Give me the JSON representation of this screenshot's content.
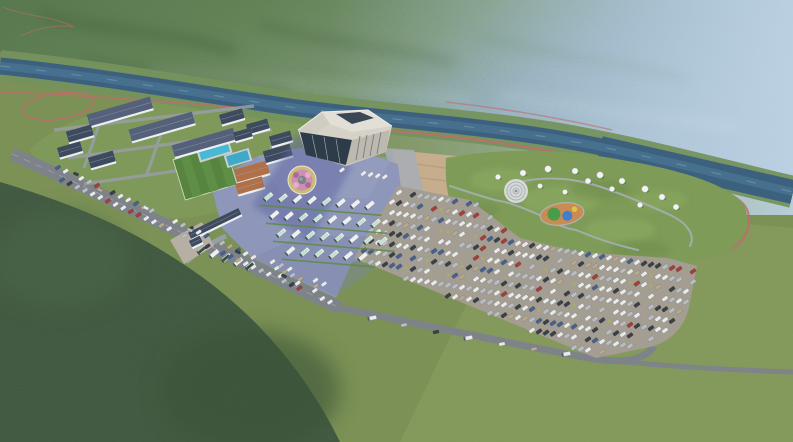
{
  "meta": {
    "type": "aerial-architectural-rendering",
    "description": "Bird's-eye 3D rendering of a riverside tourist service area: visitor center hall, plaza with flower bed, bus lot, large car parking lot, glamping park with dome tents and teepees, dormitory buildings, sports field and pools, set in a forested mountain valley with a river, red trails and drifting clouds",
    "width": 793,
    "height": 442
  },
  "palette": {
    "mountainDark": "#46633e",
    "mountainMid": "#5e7f54",
    "mountainLight": "#7d9a78",
    "hazeBlue": "#a9c2da",
    "valleyGreen": "#7c9155",
    "meadow": "#8a9e5f",
    "forestDark": "#3f5840",
    "forestMid": "#4b6848",
    "river": "#3c617f",
    "riverLight": "#4a7492",
    "bank": "#75925e",
    "trailRed": "#c06c6c",
    "roadGray": "#7e838a",
    "roadLight": "#989ea5",
    "plaza": "#8e97b9",
    "plazaShadow": "#5f65a2",
    "lotGray": "#a49d91",
    "dirt": "#c6ad8e",
    "lawn": "#7f9c5b",
    "field": "#57853f",
    "pool": "#49b8d4",
    "pool2": "#3fa9c9",
    "roofDark": "#3e4a5e",
    "roofSlate": "#55617a",
    "roofOrange": "#b07048",
    "wallWhite": "#eceff2",
    "hallWall": "#d6d2c8",
    "hallRoof": "#e2dfd7",
    "hallGlass": "#2e3c49",
    "busWhite": "#eef1f2",
    "busMint": "#bfe3cf",
    "busDarkGreen": "#37523f",
    "carWhite": "#e8eaec",
    "carSilver": "#b9bec6",
    "carDark": "#3a4048",
    "carRed": "#a23f3b",
    "carBlue": "#46618e",
    "carTan": "#b7a98e",
    "bush": "#a9b35b",
    "treeDark": "#2e4a30",
    "treeMid": "#3d5c38",
    "treeLight": "#4f6f42",
    "cherry": "#d7a6c6",
    "cherry2": "#c791b5",
    "tentWhite": "#f2f3f4",
    "pgBase": "#cd8b52",
    "pgGreen": "#4a9b4a",
    "pgBlue": "#3f7fd0",
    "pgYellow": "#e0c245",
    "flowerPink": "#cf8fb4",
    "flowerRing": "#c9bd72",
    "rock": "#7b828c",
    "cloud": "#ffffff"
  },
  "campus": {
    "buildings": [
      [
        120,
        112,
        66,
        12,
        -16,
        "roofSlate"
      ],
      [
        162,
        127,
        66,
        12,
        -16,
        "roofSlate"
      ],
      [
        204,
        143,
        64,
        12,
        -16,
        "roofSlate"
      ],
      [
        80,
        134,
        26,
        11,
        -16,
        "roofDark"
      ],
      [
        70,
        150,
        24,
        10,
        -16,
        "roofDark"
      ],
      [
        102,
        160,
        26,
        11,
        -16,
        "roofDark"
      ],
      [
        232,
        117,
        24,
        10,
        -16,
        "roofDark"
      ],
      [
        258,
        127,
        22,
        10,
        -16,
        "roofDark"
      ],
      [
        243,
        135,
        18,
        9,
        -16,
        "roofDark"
      ],
      [
        281,
        139,
        22,
        10,
        -16,
        "roofDark"
      ],
      [
        252,
        172,
        34,
        13,
        -16,
        "roofOrange"
      ],
      [
        250,
        186,
        28,
        11,
        -16,
        "roofOrange"
      ],
      [
        278,
        154,
        28,
        12,
        -16,
        "roofDark"
      ],
      [
        215,
        224,
        56,
        7,
        -26,
        "roofDark"
      ],
      [
        196,
        242,
        12,
        7,
        -26,
        "roofDark"
      ]
    ]
  },
  "parking": {
    "bounds": [
      [
        398,
        186
      ],
      [
        470,
        200
      ],
      [
        520,
        238
      ],
      [
        578,
        252
      ],
      [
        668,
        258
      ],
      [
        697,
        266
      ],
      [
        690,
        302
      ],
      [
        652,
        346
      ],
      [
        596,
        358
      ],
      [
        354,
        258
      ],
      [
        376,
        220
      ],
      [
        392,
        196
      ]
    ],
    "row_pitch": 10.6,
    "car_spacing": 7.0,
    "row_slope": 0.16,
    "car_rot": -36,
    "car_colors": [
      [
        "carWhite",
        38
      ],
      [
        "carSilver",
        22
      ],
      [
        "carDark",
        18
      ],
      [
        "carRed",
        6
      ],
      [
        "carBlue",
        8
      ],
      [
        "carTan",
        8
      ]
    ]
  },
  "bus_area": {
    "rows": [
      {
        "x": 268,
        "y": 197,
        "n": 8,
        "step": 14.5,
        "drift": 1.2
      },
      {
        "x": 274,
        "y": 215,
        "n": 8,
        "step": 14.5,
        "drift": 1.2
      },
      {
        "x": 281,
        "y": 233,
        "n": 8,
        "step": 14.5,
        "drift": 1.2
      },
      {
        "x": 290,
        "y": 251,
        "n": 6,
        "step": 14.5,
        "drift": 1.2
      }
    ],
    "entrance_buses": [
      [
        202,
        250
      ],
      [
        214,
        254
      ],
      [
        226,
        258
      ],
      [
        238,
        262
      ],
      [
        250,
        266
      ]
    ]
  },
  "roadside": {
    "strips": [
      {
        "x1": 50,
        "y1": 164,
        "x2": 316,
        "y2": 286,
        "step": 8.4,
        "rot": -34,
        "skip": 0.22
      },
      {
        "x1": 62,
        "y1": 180,
        "x2": 330,
        "y2": 302,
        "step": 8.4,
        "rot": -34,
        "skip": 0.25
      },
      {
        "x1": 264,
        "y1": 258,
        "x2": 324,
        "y2": 284,
        "step": 8.2,
        "rot": -36,
        "skip": 0.3,
        "white": 1
      },
      {
        "x1": 272,
        "y1": 272,
        "x2": 332,
        "y2": 298,
        "step": 8.2,
        "rot": -36,
        "skip": 0.3,
        "white": 1
      },
      {
        "x1": 342,
        "y1": 170,
        "x2": 392,
        "y2": 178,
        "step": 7.2,
        "rot": -38,
        "skip": 0.25,
        "white": 1
      }
    ],
    "road_cars": [
      [
        100,
        190,
        24
      ],
      [
        146,
        208,
        24
      ],
      [
        190,
        230,
        24
      ],
      [
        238,
        252,
        24
      ],
      [
        284,
        276,
        24
      ],
      [
        76,
        174,
        24
      ]
    ],
    "bottom_vehicles": [
      [
        372,
        318,
        -11,
        1
      ],
      [
        404,
        325,
        -11,
        0
      ],
      [
        436,
        332,
        -11,
        0
      ],
      [
        468,
        338,
        -11,
        1
      ],
      [
        502,
        344,
        -11,
        0
      ],
      [
        534,
        349,
        -11,
        0
      ],
      [
        566,
        354,
        -11,
        1
      ]
    ]
  },
  "glamping": {
    "domes": [
      [
        498,
        177,
        2.6
      ],
      [
        523,
        173,
        3
      ],
      [
        548,
        169,
        3.2
      ],
      [
        575,
        171,
        3
      ],
      [
        600,
        175,
        3.2
      ],
      [
        622,
        181,
        3
      ],
      [
        645,
        189,
        3.2
      ],
      [
        662,
        197,
        3
      ],
      [
        676,
        207,
        2.8
      ],
      [
        640,
        205,
        2.6
      ],
      [
        612,
        189,
        2.6
      ],
      [
        588,
        181,
        2.8
      ],
      [
        540,
        186,
        2.4
      ],
      [
        565,
        192,
        2.4
      ]
    ],
    "teepees": [
      [
        628,
        222
      ],
      [
        643,
        229
      ],
      [
        657,
        236
      ],
      [
        671,
        243
      ],
      [
        684,
        247
      ],
      [
        636,
        244
      ],
      [
        650,
        251
      ],
      [
        664,
        256
      ],
      [
        678,
        258
      ],
      [
        694,
        250
      ],
      [
        699,
        237
      ],
      [
        691,
        226
      ]
    ],
    "cabins": [
      [
        505,
        206
      ],
      [
        517,
        210
      ],
      [
        638,
        198
      ],
      [
        652,
        202
      ],
      [
        664,
        206
      ]
    ]
  },
  "vegetation": {
    "lines": [
      {
        "x1": 30,
        "y1": 156,
        "x2": 332,
        "y2": 295,
        "step": 11,
        "r0": 2,
        "r1": 3.2,
        "j": 2.5,
        "skip": 0.12
      },
      {
        "x1": 22,
        "y1": 170,
        "x2": 322,
        "y2": 308,
        "step": 12,
        "r0": 2,
        "r1": 3,
        "j": 2.5,
        "skip": 0.15
      },
      {
        "x1": 528,
        "y1": 348,
        "x2": 790,
        "y2": 364,
        "step": 13,
        "r0": 2,
        "r1": 3,
        "j": 1.5,
        "skip": 0.1
      },
      {
        "x1": 534,
        "y1": 357,
        "x2": 790,
        "y2": 373,
        "step": 14,
        "r0": 1.8,
        "r1": 2.8,
        "j": 1.5,
        "skip": 0.15
      },
      {
        "x1": 346,
        "y1": 250,
        "x2": 596,
        "y2": 353,
        "step": 9.5,
        "r0": 1.8,
        "r1": 2.8,
        "j": 1.5,
        "skip": 0.12
      },
      {
        "x1": 292,
        "y1": 208,
        "x2": 297,
        "y2": 252,
        "step": 9,
        "r0": 2.2,
        "r1": 2.6,
        "j": 0.5,
        "skip": 0
      },
      {
        "x1": 2,
        "y1": 86,
        "x2": 258,
        "y2": 112,
        "step": 15,
        "r0": 1.8,
        "r1": 2.8,
        "j": 3,
        "skip": 0.2
      },
      {
        "x1": 356,
        "y1": 254,
        "x2": 394,
        "y2": 194,
        "step": 7.5,
        "r0": 1.8,
        "r1": 2.4,
        "j": 1,
        "skip": 0.1
      },
      {
        "x1": 400,
        "y1": 188,
        "x2": 470,
        "y2": 201,
        "step": 8,
        "r0": 1.2,
        "r1": 1.8,
        "j": 1,
        "skip": 0.1,
        "bush": 1
      },
      {
        "x1": 470,
        "y1": 201,
        "x2": 520,
        "y2": 238,
        "step": 8,
        "r0": 1.2,
        "r1": 1.8,
        "j": 1,
        "skip": 0.1,
        "bush": 1
      },
      {
        "x1": 520,
        "y1": 238,
        "x2": 578,
        "y2": 252,
        "step": 8,
        "r0": 1.2,
        "r1": 1.8,
        "j": 1,
        "skip": 0.1,
        "bush": 1
      },
      {
        "x1": 578,
        "y1": 252,
        "x2": 666,
        "y2": 258,
        "step": 8,
        "r0": 1.2,
        "r1": 1.8,
        "j": 1,
        "skip": 0.1,
        "bush": 1
      },
      {
        "x1": 164,
        "y1": 234,
        "x2": 190,
        "y2": 258,
        "step": 8,
        "r0": 2.4,
        "r1": 3,
        "j": 1,
        "skip": 0
      }
    ],
    "trees": [
      [
        66,
        126,
        2.6
      ],
      [
        58,
        142,
        2.4
      ],
      [
        92,
        130,
        2.6
      ],
      [
        112,
        120,
        2.4
      ],
      [
        150,
        114,
        2.6
      ],
      [
        190,
        108,
        2.4
      ],
      [
        226,
        110,
        2.6
      ],
      [
        252,
        116,
        2.4
      ],
      [
        276,
        126,
        2.6
      ],
      [
        292,
        138,
        2.8
      ],
      [
        162,
        150,
        2.4
      ],
      [
        200,
        160,
        2.6
      ],
      [
        232,
        170,
        2.4
      ],
      [
        258,
        178,
        2.6
      ],
      [
        120,
        150,
        2.4
      ],
      [
        136,
        164,
        2.6
      ],
      [
        106,
        174,
        2.4
      ],
      [
        88,
        162,
        2.4
      ],
      [
        168,
        198,
        2.8
      ],
      [
        190,
        210,
        2.6
      ],
      [
        214,
        220,
        2.6
      ],
      [
        240,
        230,
        2.4
      ],
      [
        154,
        220,
        2.6
      ],
      [
        130,
        208,
        2.4
      ],
      [
        318,
        130,
        2.4
      ],
      [
        336,
        140,
        2.6
      ],
      [
        472,
        212,
        2.8
      ],
      [
        486,
        230,
        2.6
      ],
      [
        530,
        248,
        2.4
      ],
      [
        604,
        250,
        2.6
      ],
      [
        688,
        194,
        2.6
      ],
      [
        706,
        214,
        2.8
      ],
      [
        580,
        158,
        2.4
      ],
      [
        540,
        154,
        2.6
      ],
      [
        612,
        160,
        2.4
      ],
      [
        662,
        176,
        2.6
      ],
      [
        700,
        186,
        2.4
      ],
      [
        724,
        240,
        3
      ],
      [
        744,
        262,
        3
      ],
      [
        762,
        292,
        3.2
      ],
      [
        732,
        306,
        3
      ],
      [
        706,
        282,
        2.8
      ],
      [
        478,
        164,
        2.4
      ]
    ],
    "cherries": [
      [
        92,
        146,
        3.6
      ],
      [
        104,
        160,
        3.2
      ],
      [
        118,
        174,
        3.8
      ],
      [
        134,
        188,
        3.4
      ],
      [
        152,
        200,
        3.6
      ],
      [
        88,
        122,
        3
      ],
      [
        146,
        131,
        3.2
      ],
      [
        186,
        120,
        3
      ],
      [
        216,
        131,
        3.4
      ],
      [
        240,
        145,
        3.2
      ],
      [
        262,
        152,
        3
      ],
      [
        288,
        166,
        3.2
      ],
      [
        304,
        262,
        3.8
      ],
      [
        318,
        274,
        3.6
      ],
      [
        332,
        284,
        3.4
      ],
      [
        374,
        256,
        3.2
      ],
      [
        388,
        263,
        3
      ],
      [
        152,
        171,
        3.2
      ],
      [
        176,
        185,
        3.4
      ],
      [
        206,
        197,
        3.2
      ],
      [
        230,
        209,
        3
      ],
      [
        250,
        220,
        3.2
      ],
      [
        18,
        88,
        2.2
      ],
      [
        34,
        92,
        2
      ],
      [
        50,
        96,
        2.2
      ]
    ]
  },
  "decor": {
    "flag_colors": [
      "#d94545",
      "#e8cf4a",
      "#4aa050",
      "#4a6fd0",
      "#f0f0f0"
    ],
    "flags": [
      [
        447,
        106,
        0.8
      ],
      [
        547,
        102,
        0.9
      ],
      [
        629,
        131,
        1
      ],
      [
        776,
        113,
        0.9
      ],
      [
        424,
        326,
        1.4
      ],
      [
        601,
        371,
        1.3
      ]
    ],
    "huts": [
      [
        414,
        343,
        4.4
      ],
      [
        448,
        347,
        4
      ]
    ],
    "animals": [
      [
        360,
        348
      ],
      [
        369,
        351
      ],
      [
        380,
        347
      ],
      [
        390,
        350
      ],
      [
        399,
        352
      ]
    ],
    "people": [
      [
        265,
        190
      ],
      [
        272,
        204
      ],
      [
        281,
        218
      ],
      [
        292,
        230
      ],
      [
        305,
        196
      ],
      [
        312,
        210
      ],
      [
        318,
        224
      ],
      [
        330,
        200
      ],
      [
        338,
        215
      ],
      [
        252,
        201
      ],
      [
        258,
        214
      ],
      [
        248,
        228
      ],
      [
        350,
        206
      ],
      [
        342,
        188
      ],
      [
        286,
        176
      ],
      [
        296,
        170
      ]
    ]
  },
  "clouds": [
    [
      0,
      262,
      85,
      95,
      0.8,
      "b16"
    ],
    [
      30,
      345,
      125,
      115,
      0.92,
      "b16"
    ],
    [
      85,
      418,
      175,
      75,
      0.95,
      "b16"
    ],
    [
      -8,
      182,
      62,
      62,
      0.6,
      "b10"
    ],
    [
      152,
      440,
      150,
      45,
      0.55,
      "b10"
    ],
    [
      295,
      440,
      140,
      35,
      0.45,
      "b10"
    ],
    [
      425,
      436,
      150,
      35,
      0.5,
      "b10"
    ],
    [
      565,
      432,
      150,
      40,
      0.55,
      "b10"
    ],
    [
      700,
      422,
      165,
      60,
      0.7,
      "b16"
    ],
    [
      775,
      342,
      95,
      80,
      0.6,
      "b16"
    ],
    [
      790,
      242,
      70,
      92,
      0.55,
      "b10"
    ],
    [
      784,
      150,
      62,
      72,
      0.45,
      "b10"
    ],
    [
      762,
      62,
      88,
      56,
      0.42,
      "b10"
    ],
    [
      640,
      62,
      110,
      36,
      0.22,
      "b10"
    ],
    [
      480,
      42,
      100,
      28,
      0.16,
      "b10"
    ],
    [
      42,
      62,
      66,
      28,
      0.5,
      "b10"
    ],
    [
      112,
      32,
      82,
      24,
      0.32,
      "b10"
    ],
    [
      0,
      112,
      56,
      42,
      0.42,
      "b10"
    ],
    [
      725,
      302,
      92,
      56,
      0.45,
      "b16"
    ],
    [
      300,
      96,
      180,
      26,
      0.14,
      "b10"
    ]
  ]
}
